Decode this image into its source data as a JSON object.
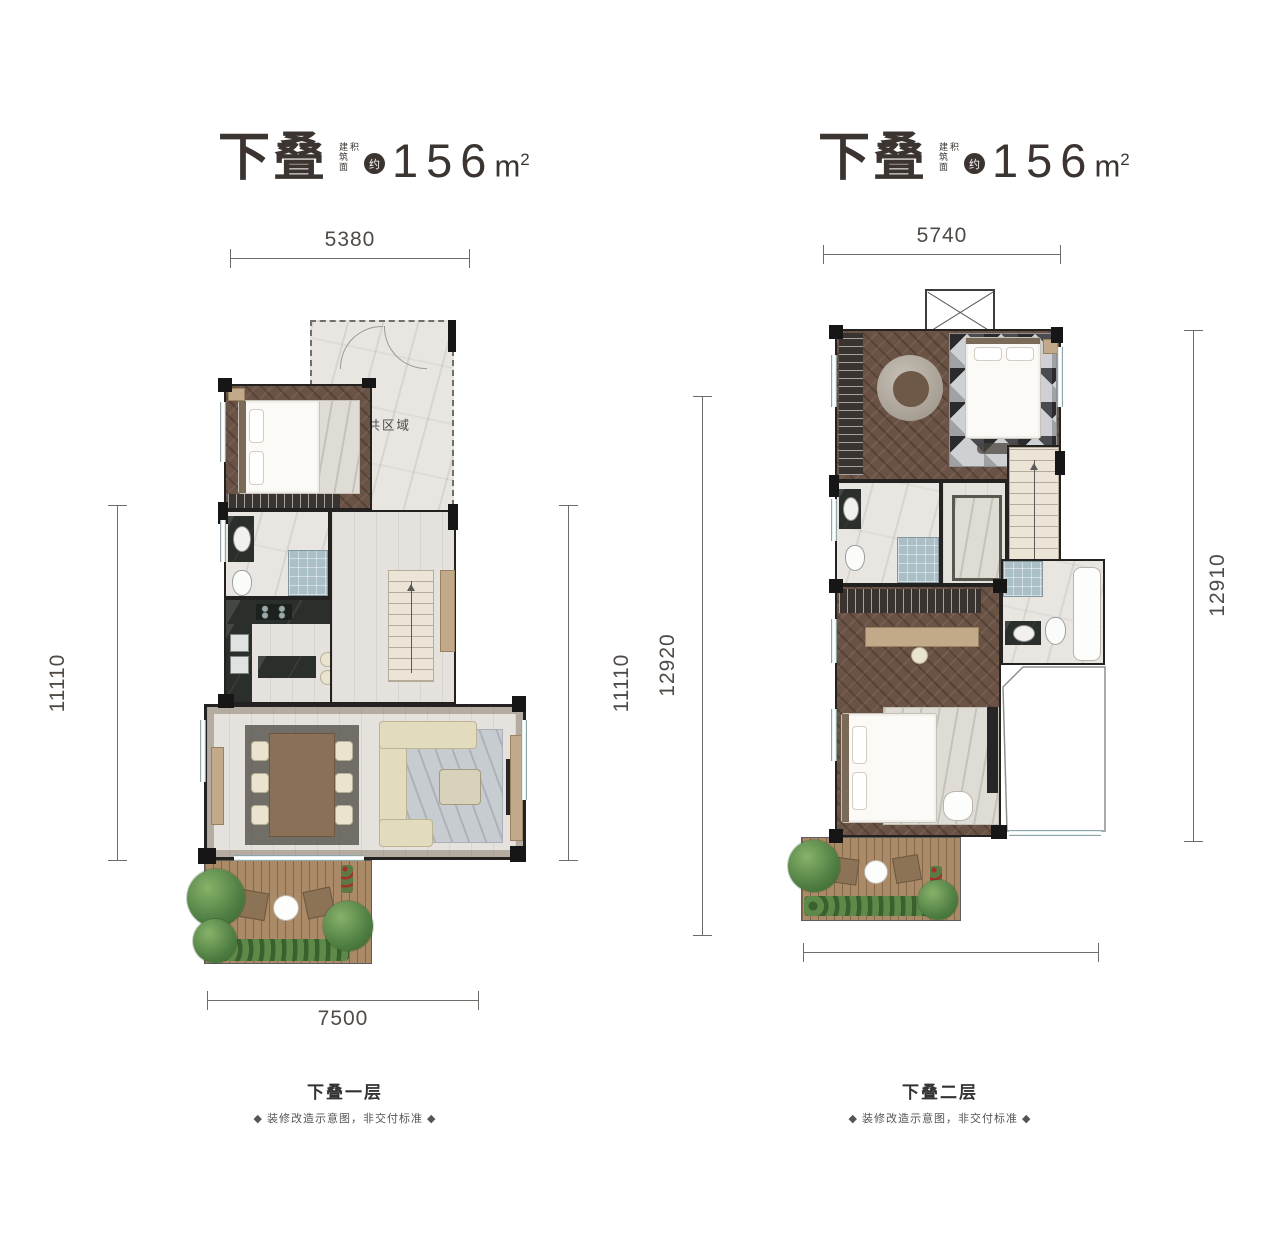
{
  "plans": [
    {
      "title": {
        "main": "下叠",
        "area_label": "建筑面积",
        "approx": "约",
        "value": "156",
        "unit": "m",
        "unit_sup": "2"
      },
      "dims": {
        "top": "5380",
        "left": "11110",
        "right": "11110",
        "bottom": "7500"
      },
      "labels": {
        "public_area": "公共区域"
      },
      "caption": {
        "title": "下叠一层",
        "note": "◆ 装修改造示意图，非交付标准 ◆"
      }
    },
    {
      "title": {
        "main": "下叠",
        "area_label": "建筑面积",
        "approx": "约",
        "value": "156",
        "unit": "m",
        "unit_sup": "2"
      },
      "dims": {
        "top": "5740",
        "left": "12920",
        "right": "12910",
        "bottom": ""
      },
      "caption": {
        "title": "下叠二层",
        "note": "◆ 装修改造示意图，非交付标准 ◆"
      }
    }
  ],
  "colors": {
    "title_text": "#3b3430",
    "dimension_text": "#4f4a46",
    "wall": "#161616",
    "wood_floor": "#6a5244",
    "marble_floor": "#e9e6e2",
    "deck_wood": "#ab8a67",
    "window_glass": "#d7e7ea",
    "kitchen_counter": "#2a2f2b",
    "sofa": "#e3dbbd",
    "plants": "#4e7d42"
  }
}
